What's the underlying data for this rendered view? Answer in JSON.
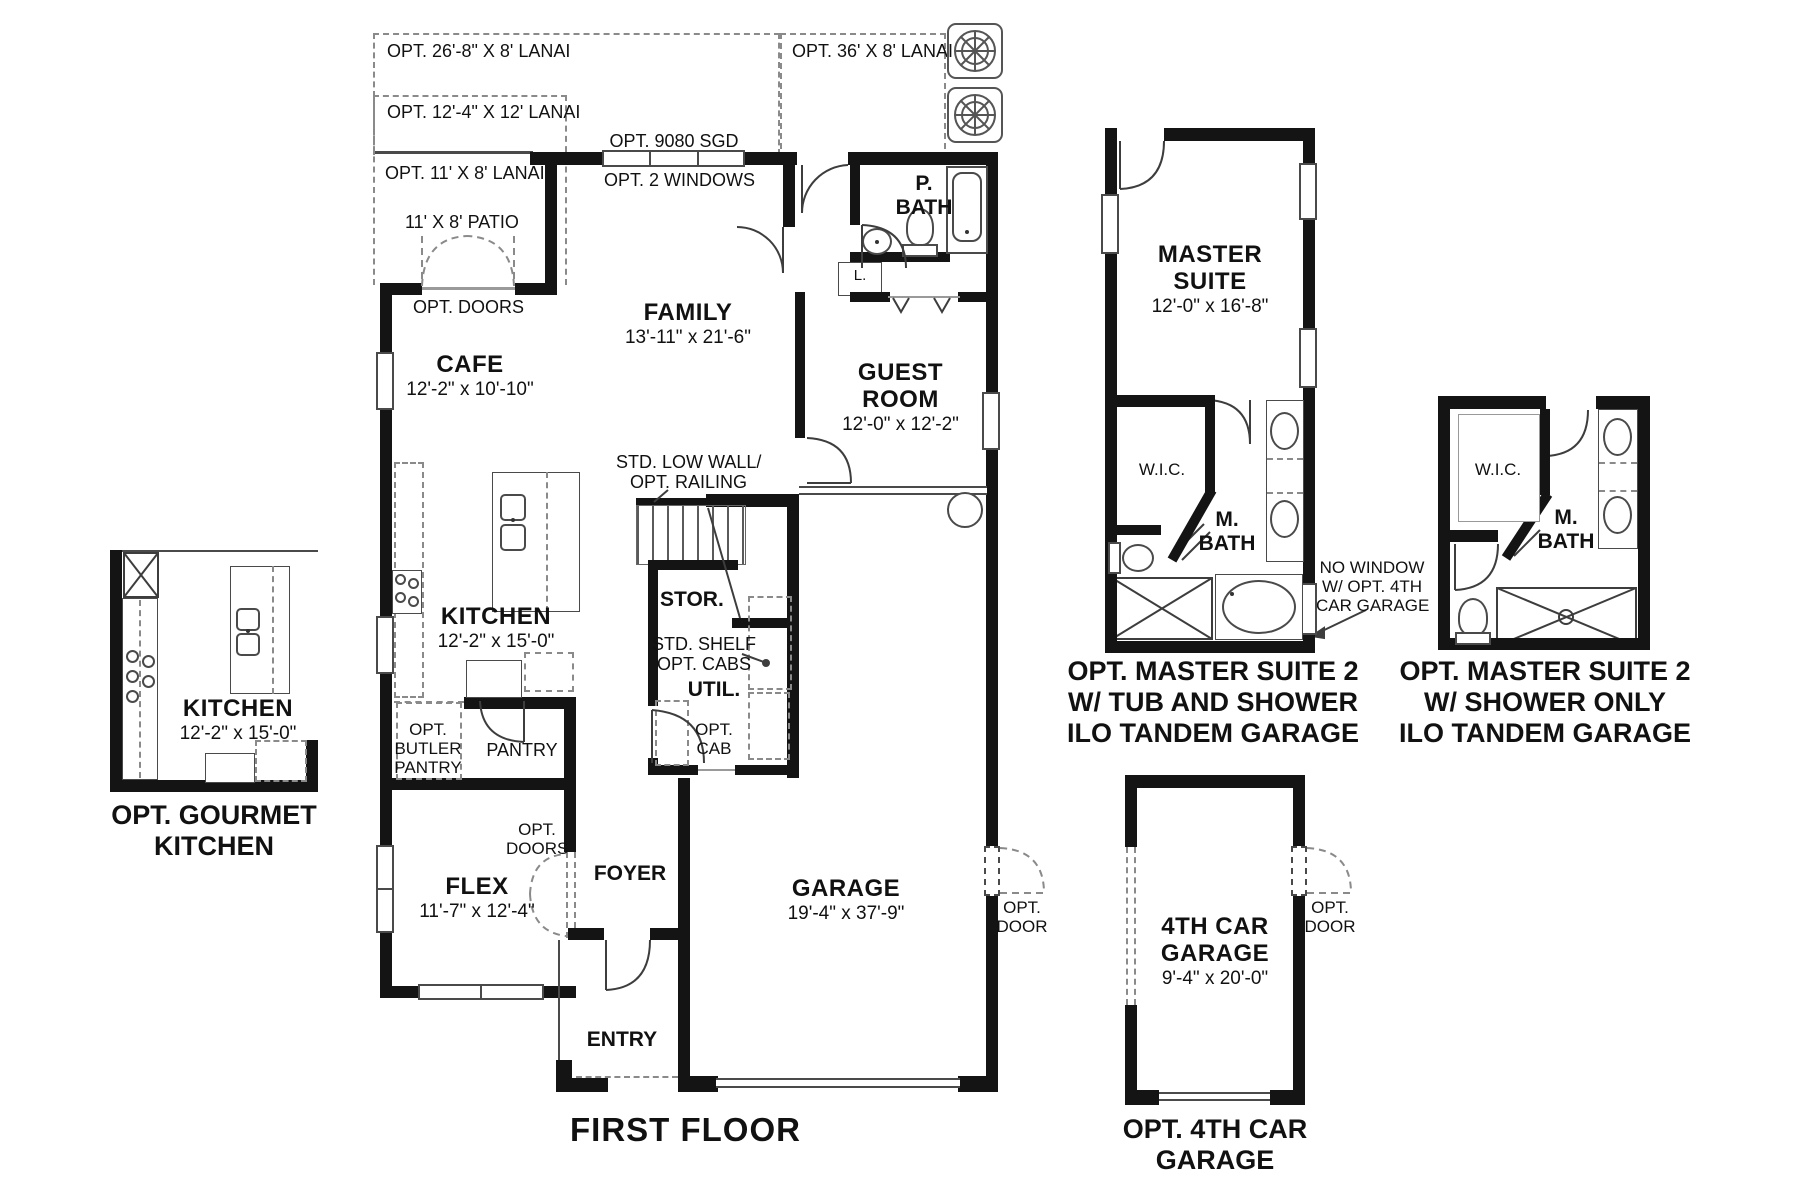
{
  "colors": {
    "wall": "#141414",
    "line": "#4a4a4a",
    "dash": "#8a8a8a",
    "text": "#111111",
    "bg": "#ffffff"
  },
  "titles": {
    "first_floor": "FIRST FLOOR"
  },
  "main": {
    "lanai_26": "OPT. 26'-8\" X 8' LANAI",
    "lanai_12": "OPT. 12'-4\" X 12' LANAI",
    "lanai_11": "OPT. 11' X 8' LANAI",
    "patio": "11' X 8' PATIO",
    "opt_doors": "OPT. DOORS",
    "sgd": "OPT. 9080 SGD",
    "windows2": "OPT. 2 WINDOWS",
    "lanai_36": "OPT. 36' X 8' LANAI",
    "pbath_1": "P.",
    "pbath_2": "BATH",
    "linen": "L.",
    "family": "FAMILY",
    "family_dims": "13'-11\" x 21'-6\"",
    "cafe": "CAFE",
    "cafe_dims": "12'-2\" x 10'-10\"",
    "guest_1": "GUEST",
    "guest_2": "ROOM",
    "guest_dims": "12'-0\" x 12'-2\"",
    "low_wall_1": "STD. LOW WALL/",
    "low_wall_2": "OPT. RAILING",
    "stor": "STOR.",
    "shelf_1": "STD. SHELF",
    "shelf_2": "OPT. CABS",
    "util": "UTIL.",
    "opt_cab_1": "OPT.",
    "opt_cab_2": "CAB",
    "kitchen": "KITCHEN",
    "kitchen_dims": "12'-2\" x 15'-0\"",
    "butler_1": "OPT.",
    "butler_2": "BUTLER",
    "butler_3": "PANTRY",
    "pantry": "PANTRY",
    "flex": "FLEX",
    "flex_dims": "11'-7\" x 12'-4\"",
    "opt_doors_flex_1": "OPT.",
    "opt_doors_flex_2": "DOORS",
    "foyer": "FOYER",
    "entry": "ENTRY",
    "garage": "GARAGE",
    "garage_dims": "19'-4\" x 37'-9\"",
    "opt_door_1": "OPT.",
    "opt_door_2": "DOOR"
  },
  "gourmet": {
    "kitchen": "KITCHEN",
    "kitchen_dims": "12'-2\" x 15'-0\"",
    "title_1": "OPT. GOURMET",
    "title_2": "KITCHEN"
  },
  "master_tub": {
    "name_1": "MASTER",
    "name_2": "SUITE",
    "dims": "12'-0\" x 16'-8\"",
    "wic": "W.I.C.",
    "mbath_1": "M.",
    "mbath_2": "BATH",
    "no_window_1": "NO WINDOW",
    "no_window_2": "W/ OPT. 4TH",
    "no_window_3": "CAR GARAGE",
    "title_1": "OPT. MASTER SUITE 2",
    "title_2": "W/ TUB AND SHOWER",
    "title_3": "ILO TANDEM GARAGE"
  },
  "master_shower": {
    "wic": "W.I.C.",
    "mbath_1": "M.",
    "mbath_2": "BATH",
    "title_1": "OPT. MASTER SUITE 2",
    "title_2": "W/ SHOWER ONLY",
    "title_3": "ILO TANDEM GARAGE"
  },
  "garage4": {
    "name_1": "4TH CAR",
    "name_2": "GARAGE",
    "dims": "9'-4\" x 20'-0\"",
    "opt_door_1": "OPT.",
    "opt_door_2": "DOOR",
    "title_1": "OPT. 4TH CAR",
    "title_2": "GARAGE"
  }
}
